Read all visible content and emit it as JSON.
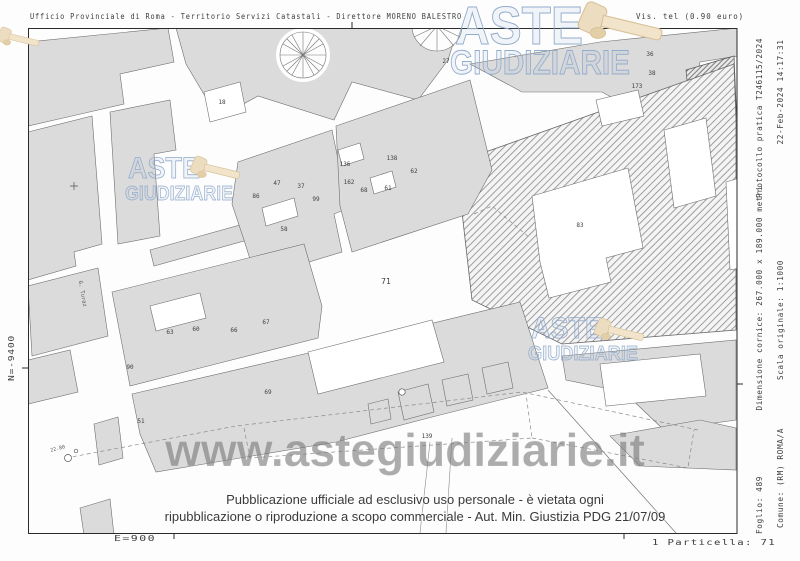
{
  "header": {
    "left": "Ufficio Provinciale di Roma - Territorio Servizi Catastali - Direttore MORENO BALESTRO",
    "right": "Vis. tel (0.90 euro)"
  },
  "margins": {
    "right_outer": {
      "top": "22-Feb-2024 14:17:31",
      "middle": "Scala originale: 1:1000",
      "bottom": "Comune: (RM) ROMA/A"
    },
    "right_inner": {
      "top": "Protocollo pratica T246115/2024",
      "middle": "Dimensione cornice: 267.000 x 189.000 metri",
      "bottom": "Foglio: 489"
    },
    "left_vertical": "N=-9400",
    "bottom_left": "E=900",
    "bottom_right": "1 Particella: 71"
  },
  "watermarks": {
    "brand_line1": "ASTE",
    "brand_line2": "GIUDIZIARIE",
    "url": "www.astegiudiziarie.it",
    "brand_color": "#92accc",
    "gavel_color": "#ecdcc0"
  },
  "disclaimer": {
    "line1": "Pubblicazione ufficiale ad esclusivo uso personale - è vietata ogni",
    "line2": "ripubblicazione o riproduzione a scopo commerciale - Aut. Min. Giustizia PDG 21/07/09"
  },
  "map": {
    "subject_parcel": "71",
    "parcel_labels": [
      {
        "n": "18",
        "x": 222,
        "y": 104
      },
      {
        "n": "86",
        "x": 256,
        "y": 198
      },
      {
        "n": "47",
        "x": 277,
        "y": 185
      },
      {
        "n": "37",
        "x": 301,
        "y": 188
      },
      {
        "n": "99",
        "x": 316,
        "y": 201
      },
      {
        "n": "58",
        "x": 284,
        "y": 231
      },
      {
        "n": "136",
        "x": 345,
        "y": 166
      },
      {
        "n": "162",
        "x": 349,
        "y": 184
      },
      {
        "n": "68",
        "x": 364,
        "y": 192
      },
      {
        "n": "61",
        "x": 388,
        "y": 190
      },
      {
        "n": "138",
        "x": 392,
        "y": 160
      },
      {
        "n": "62",
        "x": 414,
        "y": 173
      },
      {
        "n": "27",
        "x": 446,
        "y": 63
      },
      {
        "n": "36",
        "x": 650,
        "y": 56
      },
      {
        "n": "38",
        "x": 652,
        "y": 75
      },
      {
        "n": "173",
        "x": 637,
        "y": 88
      },
      {
        "n": "83",
        "x": 580,
        "y": 227
      },
      {
        "n": "63",
        "x": 170,
        "y": 334
      },
      {
        "n": "60",
        "x": 196,
        "y": 331
      },
      {
        "n": "66",
        "x": 234,
        "y": 332
      },
      {
        "n": "67",
        "x": 266,
        "y": 324
      },
      {
        "n": "90",
        "x": 130,
        "y": 369
      },
      {
        "n": "51",
        "x": 141,
        "y": 423
      },
      {
        "n": "69",
        "x": 268,
        "y": 394
      },
      {
        "n": "139",
        "x": 427,
        "y": 438
      },
      {
        "n": "71",
        "x": 386,
        "y": 284,
        "big": true
      }
    ],
    "annotations": [
      {
        "t": "22.80",
        "x": 58,
        "y": 450,
        "s": 5,
        "r": -14
      },
      {
        "t": "G. Turaz",
        "x": 81,
        "y": 294,
        "s": 5.5,
        "r": 80
      }
    ]
  }
}
